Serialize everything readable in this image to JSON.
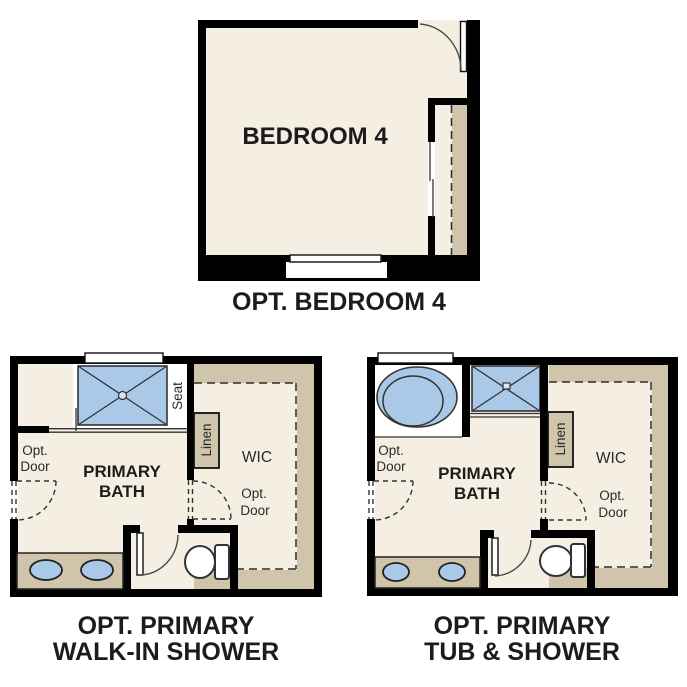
{
  "colors": {
    "wall": "#000000",
    "floor_cream": "#f5efe3",
    "shelf_tan": "#d0c4ab",
    "fixture_blue": "#aac9e9",
    "label_text": "#1c1c1c",
    "background": "#ffffff"
  },
  "plans": {
    "bedroom4": {
      "title": "OPT. BEDROOM 4",
      "room_label": "BEDROOM 4",
      "fixtures": [
        "entry-door-swing",
        "bypass-closet-doors",
        "closet-shelf-with-rod",
        "window"
      ]
    },
    "walkin_shower": {
      "title_line1": "OPT. PRIMARY",
      "title_line2": "WALK-IN SHOWER",
      "room_label_line1": "PRIMARY",
      "room_label_line2": "BATH",
      "seat_label": "Seat",
      "linen_label": "Linen",
      "wic_label": "WIC",
      "opt_door_left_line1": "Opt.",
      "opt_door_left_line2": "Door",
      "opt_door_wic_line1": "Opt.",
      "opt_door_wic_line2": "Door",
      "fixtures": [
        "walk-in-shower-tile",
        "shower-seat",
        "window",
        "double-sink-vanity",
        "toilet",
        "water-closet-door-swing",
        "optional-door-openings",
        "linen-shelf",
        "wic-shelving"
      ]
    },
    "tub_shower": {
      "title_line1": "OPT. PRIMARY",
      "title_line2": "TUB & SHOWER",
      "room_label_line1": "PRIMARY",
      "room_label_line2": "BATH",
      "linen_label": "Linen",
      "wic_label": "WIC",
      "opt_door_left_line1": "Opt.",
      "opt_door_left_line2": "Door",
      "opt_door_wic_line1": "Opt.",
      "opt_door_wic_line2": "Door",
      "fixtures": [
        "oval-soaking-tub",
        "shower-tile",
        "window",
        "double-sink-vanity",
        "toilet",
        "water-closet-door-swing",
        "optional-door-openings",
        "linen-shelf",
        "wic-shelving"
      ]
    }
  }
}
